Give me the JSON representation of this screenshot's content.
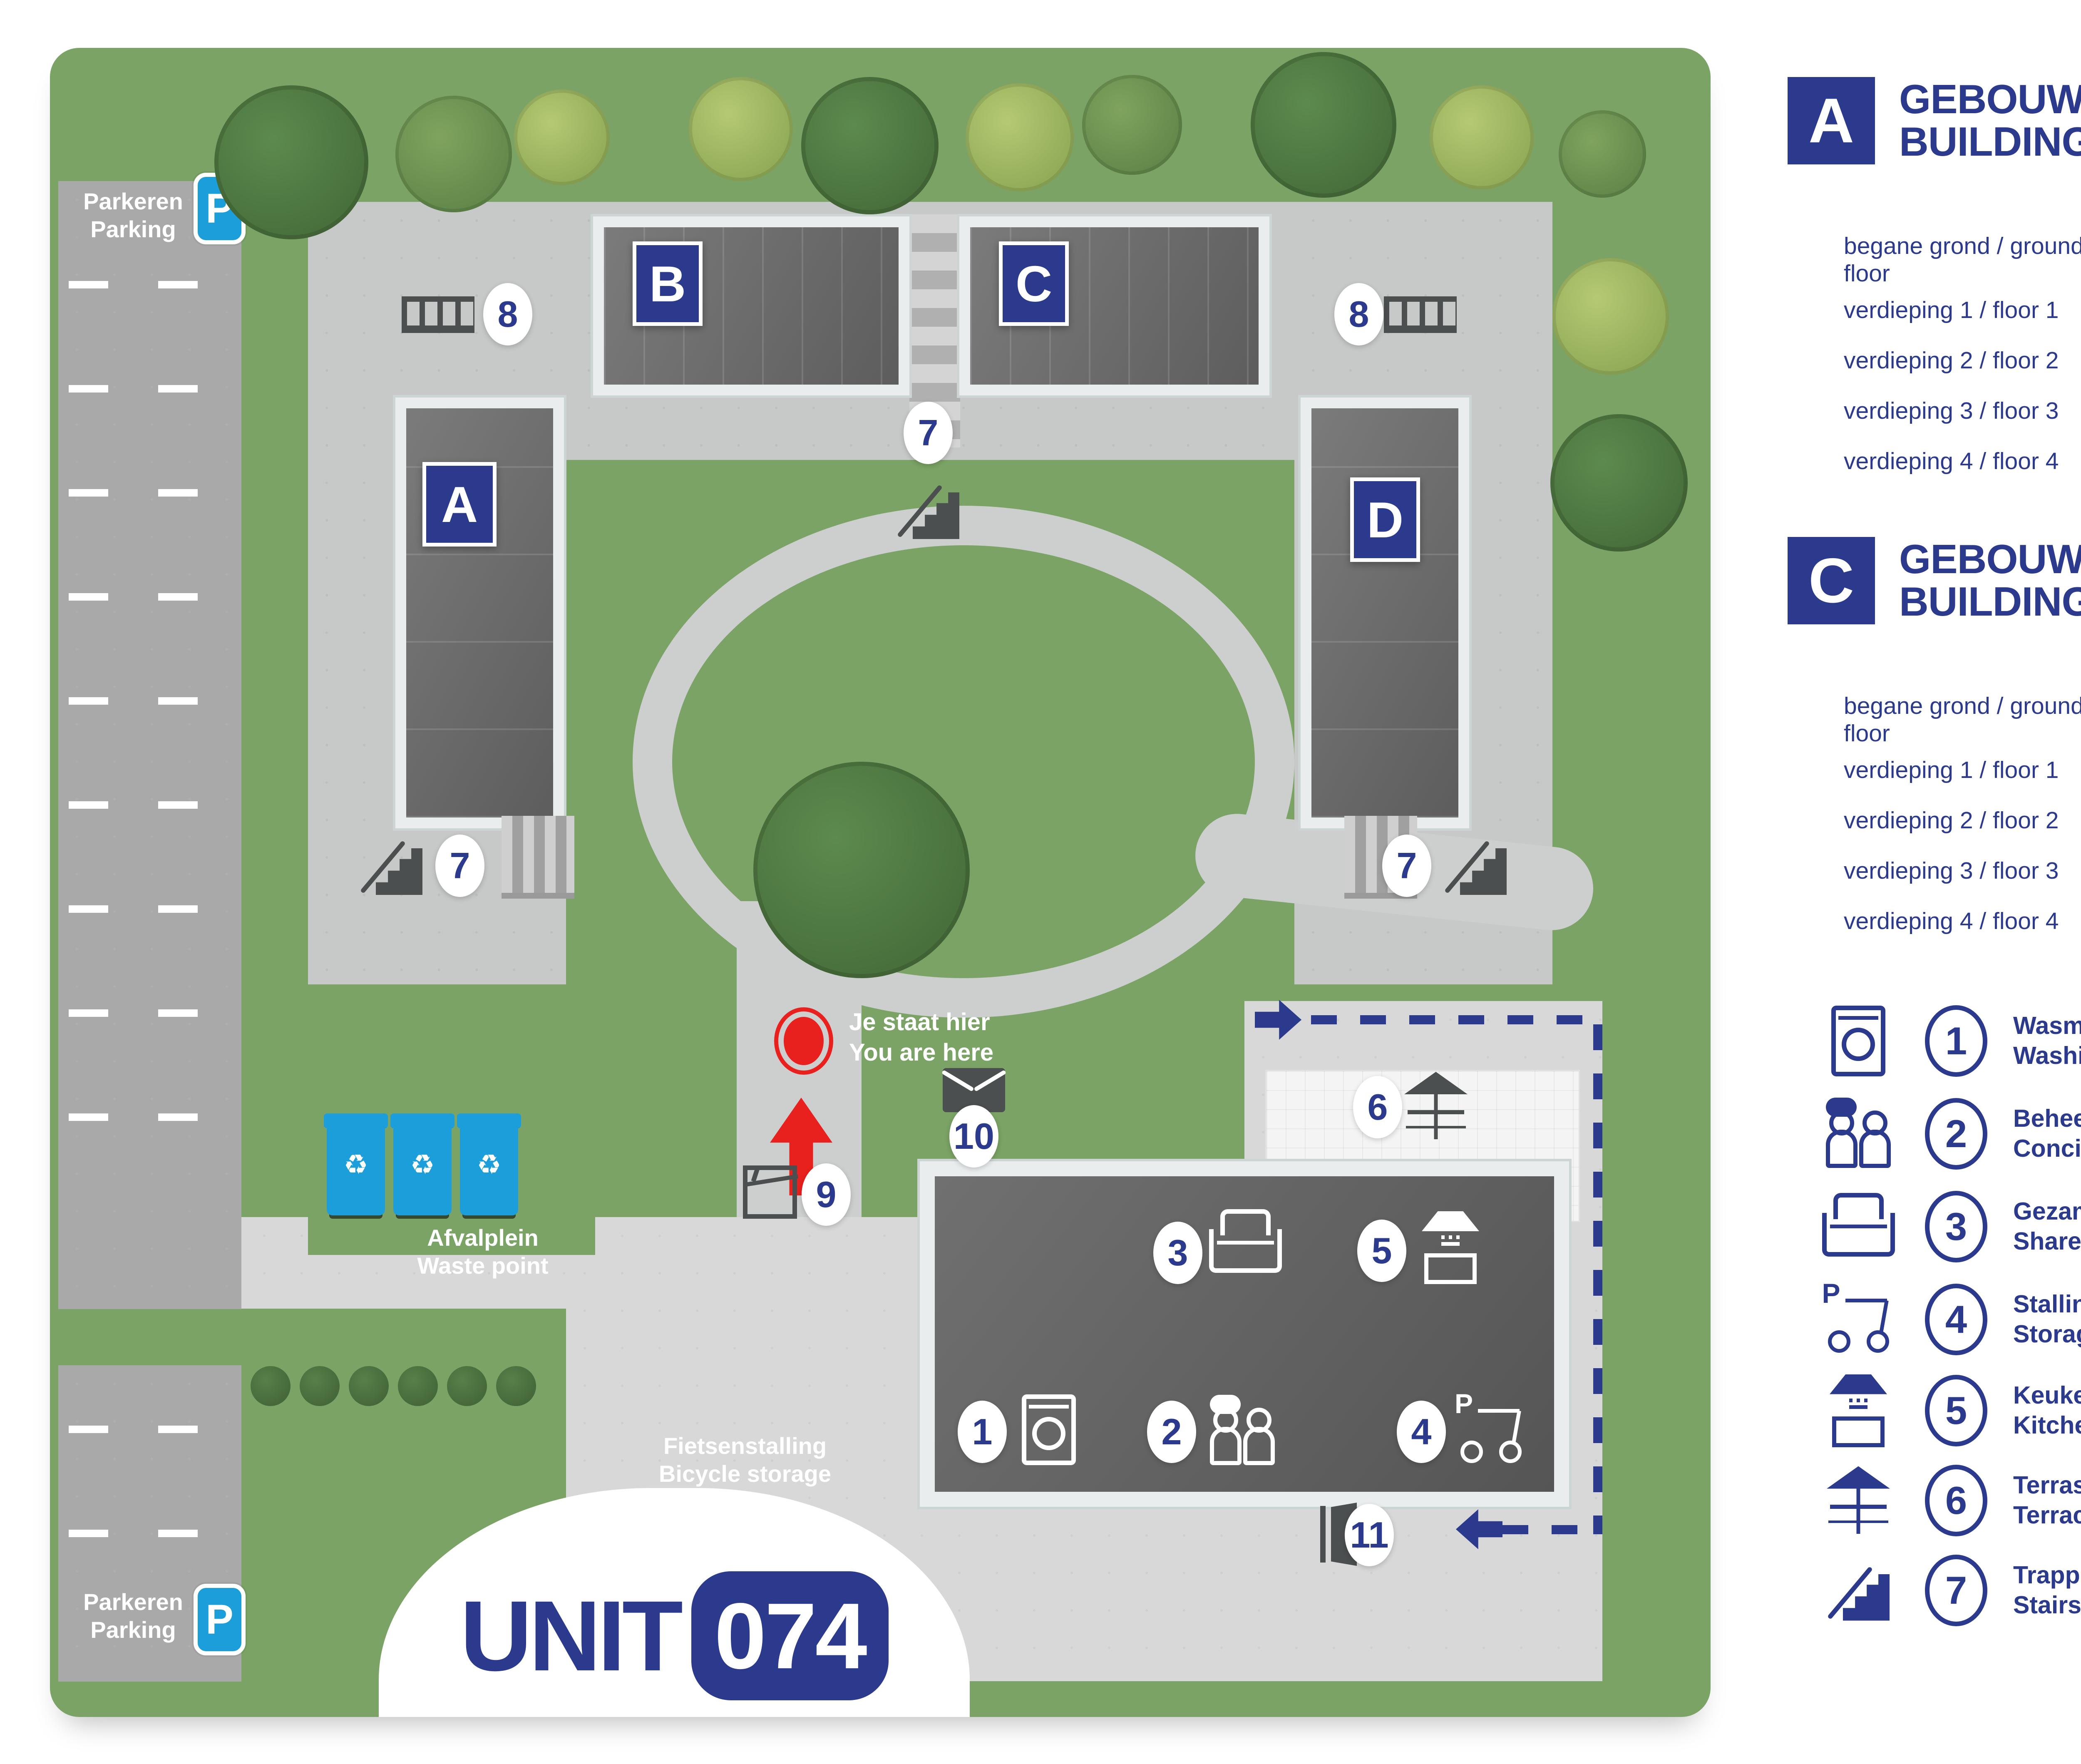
{
  "colors": {
    "navy": "#2b3a8c",
    "sign_blue": "#1b9ed9",
    "red": "#e8201e",
    "map_green": "#7ba365",
    "purple": "#7d3a8c"
  },
  "icons": {
    "recycle": "♻"
  },
  "map": {
    "parking": {
      "line1": "Parkeren",
      "line2": "Parking",
      "sign": "P"
    },
    "you_are_here": {
      "line1": "Je staat hier",
      "line2": "You are here"
    },
    "waste_point": {
      "line1": "Afvalplein",
      "line2": "Waste point"
    },
    "bicycle_storage": {
      "line1": "Fietsenstalling",
      "line2": "Bicycle storage"
    },
    "unit_logo": {
      "prefix": "UNIT",
      "number": "074"
    }
  },
  "buildings": [
    {
      "letter": "A",
      "title_line1": "GEBOUW",
      "title_line2": "BUILDING",
      "floors": [
        {
          "label": "begane grond / ground floor",
          "range": "198 - 220"
        },
        {
          "label": "verdieping 1 / floor 1",
          "range": "102 - 124"
        },
        {
          "label": "verdieping 2 / floor 2",
          "range": "126 - 148"
        },
        {
          "label": "verdieping 3 / floor 3",
          "range": "150 - 172"
        },
        {
          "label": "verdieping 4 / floor 4",
          "range": "174 - 196"
        }
      ]
    },
    {
      "letter": "B",
      "title_line1": "GEBOUW",
      "title_line2": "BUILDING",
      "floors": [
        {
          "label": "begane grond / ground floor",
          "range": "222 - 236"
        },
        {
          "label": "verdieping 1 / floor 1",
          "range": "238 - 252"
        },
        {
          "label": "verdieping 2 / floor 2",
          "range": "270 - 284"
        },
        {
          "label": "verdieping 3 / floor 3",
          "range": "302 - 316"
        },
        {
          "label": "verdieping 4 / floor 4",
          "range": "334 - 348"
        }
      ]
    },
    {
      "letter": "C",
      "title_line1": "GEBOUW",
      "title_line2": "BUILDING",
      "floors": [
        {
          "label": "begane grond / ground floor",
          "range": "366 - 380"
        },
        {
          "label": "verdieping 1 / floor 1",
          "range": "254 - 268"
        },
        {
          "label": "verdieping 2 / floor 2",
          "range": "286 - 300"
        },
        {
          "label": "verdieping 3 / floor 3",
          "range": "318 - 332"
        },
        {
          "label": "verdieping 4 / floor 4",
          "range": "350 - 364"
        }
      ]
    },
    {
      "letter": "D",
      "title_line1": "GEBOUW",
      "title_line2": "BUILDING",
      "floors": [
        {
          "label": "begane grond / ground floor",
          "range": "382 - 404"
        },
        {
          "label": "verdieping 1 / floor 1",
          "range": "406 - 428"
        },
        {
          "label": "verdieping 2 / floor 2",
          "range": "430 - 452"
        },
        {
          "label": "verdieping 3 / floor 3",
          "range": "454 - 476"
        },
        {
          "label": "verdieping 4 / floor 4",
          "range": "478 - 500"
        }
      ]
    }
  ],
  "legend": [
    {
      "num": "1",
      "icon": "washing-machine-icon",
      "line1": "Wasmachines en wasdrogers",
      "line2": "Washing machines and dryers"
    },
    {
      "num": "2",
      "icon": "concierge-icon",
      "line1": "Beheerder",
      "line2": "Concierge"
    },
    {
      "num": "3",
      "icon": "sofa-icon",
      "line1": "Gezamenlijke woonkamer",
      "line2": "Shared living room"
    },
    {
      "num": "4",
      "icon": "ebike-parking-icon",
      "line1": "Stalling elektrische voertuigen",
      "line2": "Storage electric vehicles"
    },
    {
      "num": "5",
      "icon": "kitchen-icon",
      "line1": "Keuken",
      "line2": "Kitchen"
    },
    {
      "num": "6",
      "icon": "terrace-icon",
      "line1": "Terras",
      "line2": "Terrace"
    },
    {
      "num": "7",
      "icon": "stairs-icon",
      "line1": "Trappen",
      "line2": "Stairs"
    },
    {
      "num": "8",
      "icon": "aerial-walkway-icon",
      "line1": "Loopbrug",
      "line2": "Aerial walkway"
    },
    {
      "num": "9",
      "icon": "parcel-point-icon",
      "line1": "Pakketpunt",
      "line2": "Parcel point"
    },
    {
      "num": "10",
      "icon": "letterbox-icon",
      "line1": "Brievenbus",
      "line2": "Letterbox"
    },
    {
      "num": "11",
      "icon": "door-icon",
      "line1": "Deur stalling",
      "line2": "Access door to store"
    }
  ],
  "route_note": {
    "line1": "Looproute elektrische voertuigen",
    "line2": "Walking route for electric vehicles"
  },
  "brand": {
    "name": "welbions",
    "registered": "®",
    "tagline_line1": "Thuis in Borne",
    "tagline_line2": "en Hengelo"
  }
}
